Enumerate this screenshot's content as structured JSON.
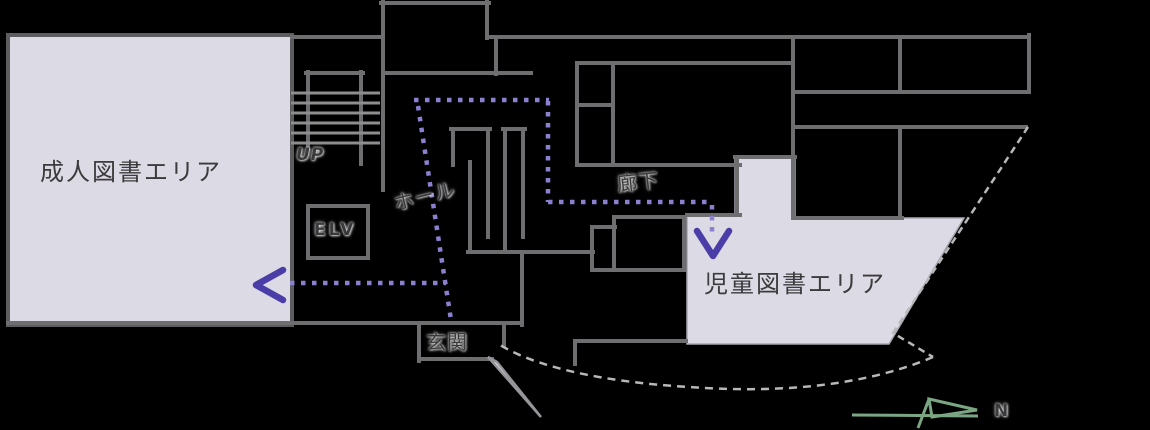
{
  "areas": {
    "adult": {
      "label": "成人図書エリア"
    },
    "children": {
      "label": "児童図書エリア"
    }
  },
  "labels": {
    "hall": "ホール",
    "corridor": "廊下",
    "entrance": "玄関",
    "elevator": "ELV",
    "stairs_up": "UP",
    "compass_north": "N"
  },
  "colors": {
    "background": "#000000",
    "wall": "#6e6e70",
    "area_fill": "#dcdae4",
    "area_border": "#5d5d5f",
    "route_dots": "#8a80d0",
    "route_arrow": "#4b3da8",
    "dashed_outline": "#b8b8b8",
    "compass_green": "#7aa683",
    "text": "#3a3a3c"
  }
}
